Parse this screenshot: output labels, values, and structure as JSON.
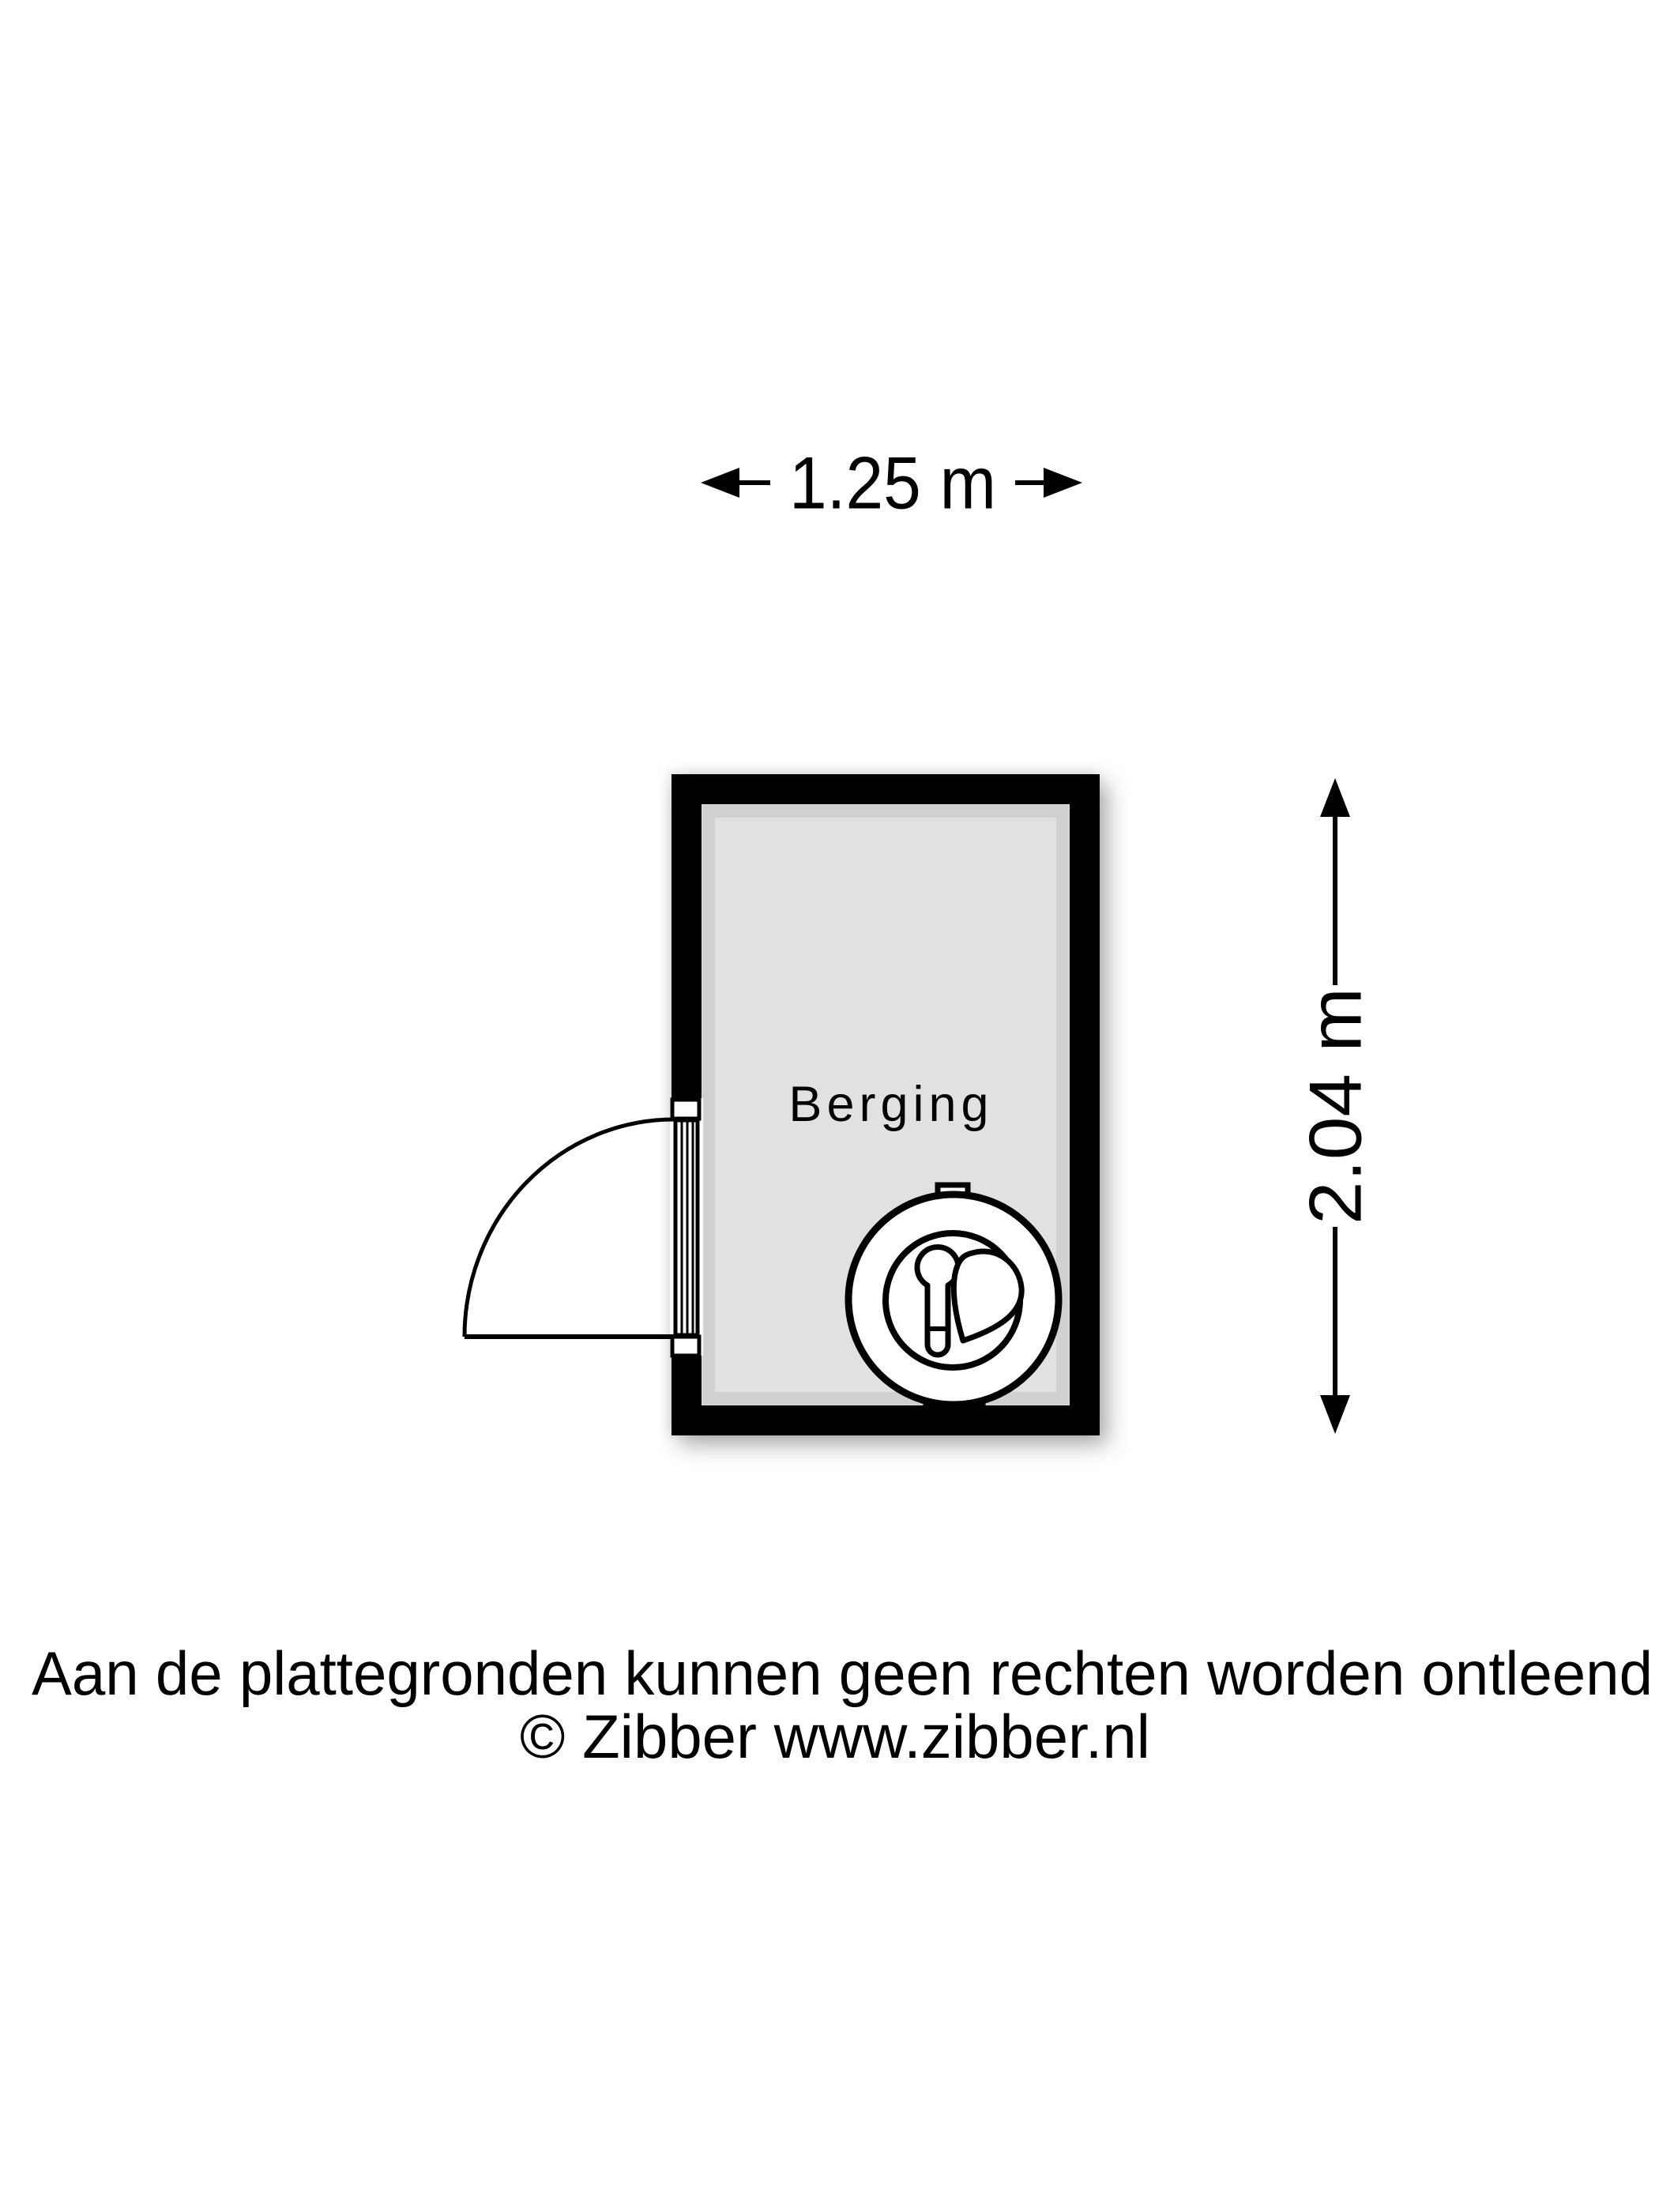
{
  "floorplan": {
    "room": {
      "label": "Berging",
      "floor_color": "#e1e1e1",
      "wall_color": "#000000"
    },
    "dimensions": {
      "width_label": "1.25 m",
      "height_label": "2.04 m"
    },
    "icons": {
      "washing_machine": "washing-machine-icon",
      "door": "door-swing-icon",
      "width_arrows": "horizontal-dimension-arrows",
      "height_arrows": "vertical-dimension-arrows"
    },
    "line_color": "#000000"
  },
  "footer": {
    "disclaimer": "Aan de plattegronden kunnen geen rechten worden ontleend",
    "copyright": "© Zibber www.zibber.nl"
  }
}
